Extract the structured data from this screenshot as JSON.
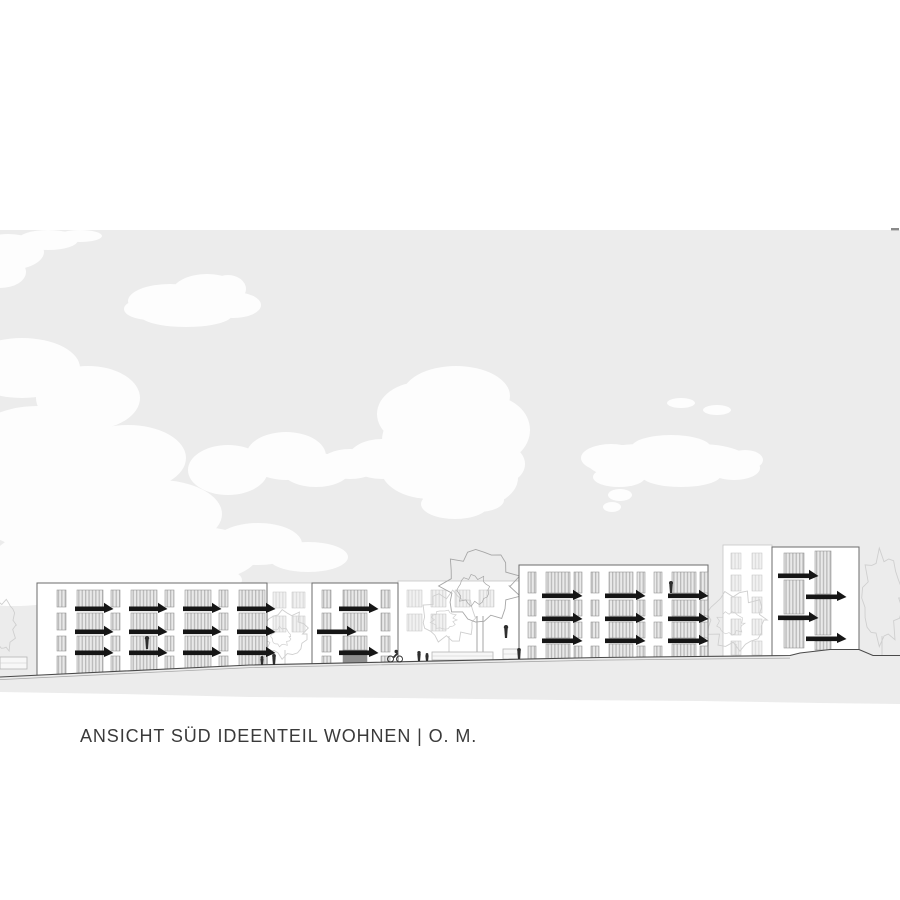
{
  "title": {
    "text": "ANSICHT SÜD IDEENTEIL WOHNEN | O. M."
  },
  "colors": {
    "page_bg": "#ffffff",
    "sky": "#ececec",
    "cloud": "#fdfdfd",
    "line_dark": "#4a4a4a",
    "line_light": "#a8a8a8",
    "building_fill": "#ffffff",
    "building_stroke": "#6b6b6b",
    "window_base": "#e9e9e9",
    "window_stripe": "#b9b9b9",
    "window_frame": "#8f8f8f",
    "balcony": "#161616",
    "door_dark": "#8e8e8e",
    "faint_stroke": "#c6c6c6",
    "faint_window_base": "#f1f1f1",
    "faint_window_stripe": "#dddddd",
    "tree_dark": "#a6a6a6",
    "tree_light": "#cfcfcf",
    "person": "#2e2e2e",
    "title_color": "#3a3a3a",
    "edge_mark": "#8a8a8a"
  },
  "scene": {
    "canvas": {
      "w": 900,
      "h": 900
    },
    "sky": {
      "top": 230,
      "edge_mark": {
        "x": 891,
        "y": 228,
        "w": 8,
        "h": 2.4
      }
    },
    "ground": {
      "line": [
        [
          0,
          677
        ],
        [
          250,
          665
        ],
        [
          600,
          657.5
        ],
        [
          790,
          655.5
        ],
        [
          800,
          653
        ],
        [
          830,
          649.5
        ],
        [
          859,
          649.5
        ],
        [
          873,
          655.5
        ],
        [
          900,
          655.5
        ]
      ],
      "bottom": [
        [
          900,
          704
        ],
        [
          820,
          703
        ],
        [
          700,
          701
        ],
        [
          560,
          700
        ],
        [
          400,
          698
        ],
        [
          250,
          697
        ],
        [
          120,
          694
        ],
        [
          0,
          692
        ]
      ],
      "light_line_max_x": 790
    },
    "clouds": [
      {
        "name": "cloud-top-left-corner",
        "ellipses": [
          [
            8,
            252,
            36,
            18
          ],
          [
            48,
            240,
            30,
            10
          ],
          [
            0,
            272,
            26,
            16
          ],
          [
            80,
            236,
            22,
            6
          ]
        ]
      },
      {
        "name": "cloud-small-upper-left",
        "ellipses": [
          [
            170,
            301,
            42,
            17
          ],
          [
            207,
            294,
            36,
            20
          ],
          [
            233,
            305,
            28,
            13
          ],
          [
            186,
            315,
            46,
            12
          ],
          [
            150,
            309,
            26,
            11
          ],
          [
            228,
            289,
            18,
            14
          ]
        ]
      },
      {
        "name": "cloud-left-edge",
        "ellipses": [
          [
            22,
            368,
            58,
            30
          ],
          [
            88,
            398,
            52,
            32
          ],
          [
            38,
            448,
            72,
            42
          ],
          [
            128,
            458,
            58,
            33
          ]
        ]
      },
      {
        "name": "cloud-lower-left-mass",
        "ellipses": [
          [
            58,
            508,
            84,
            44
          ],
          [
            158,
            514,
            64,
            34
          ],
          [
            88,
            558,
            94,
            34
          ],
          [
            198,
            554,
            60,
            27
          ],
          [
            258,
            544,
            44,
            21
          ],
          [
            308,
            557,
            40,
            15
          ],
          [
            14,
            584,
            70,
            22
          ],
          [
            228,
            470,
            40,
            25
          ],
          [
            162,
            580,
            80,
            20
          ]
        ]
      },
      {
        "name": "cloud-mid-small",
        "ellipses": [
          [
            286,
            456,
            40,
            24
          ],
          [
            316,
            470,
            34,
            17
          ]
        ]
      },
      {
        "name": "cloud-central-large",
        "ellipses": [
          [
            456,
            396,
            54,
            30
          ],
          [
            446,
            440,
            64,
            42
          ],
          [
            490,
            430,
            40,
            34
          ],
          [
            421,
            414,
            44,
            32
          ],
          [
            464,
            478,
            54,
            32
          ],
          [
            431,
            469,
            50,
            30
          ],
          [
            500,
            464,
            25,
            20
          ],
          [
            382,
            459,
            34,
            20
          ],
          [
            350,
            464,
            30,
            15
          ],
          [
            455,
            504,
            34,
            15
          ],
          [
            478,
            500,
            26,
            12
          ]
        ]
      },
      {
        "name": "cloud-right",
        "ellipses": [
          [
            641,
            462,
            54,
            18
          ],
          [
            699,
            461,
            50,
            17
          ],
          [
            611,
            458,
            30,
            14
          ],
          [
            734,
            468,
            26,
            12
          ],
          [
            671,
            448,
            40,
            13
          ],
          [
            619,
            477,
            26,
            10
          ],
          [
            681,
            475,
            40,
            12
          ],
          [
            745,
            460,
            18,
            10
          ]
        ]
      },
      {
        "name": "cloud-right-wisps",
        "ellipses": [
          [
            681,
            403,
            14,
            5
          ],
          [
            717,
            410,
            14,
            5
          ],
          [
            620,
            495,
            12,
            6
          ],
          [
            612,
            507,
            9,
            5
          ]
        ]
      }
    ],
    "background_strips": [
      {
        "name": "bg-strip-1",
        "x": 267,
        "w": 45,
        "top": 583,
        "bottom": 676,
        "windows": [
          [
            273,
            592,
            13,
            16
          ],
          [
            292,
            592,
            13,
            16
          ],
          [
            273,
            616,
            13,
            16
          ],
          [
            292,
            616,
            13,
            16
          ]
        ]
      },
      {
        "name": "bg-strip-2",
        "x": 398,
        "w": 121,
        "top": 581,
        "bottom": 672,
        "windows": [
          [
            407,
            590,
            15,
            17
          ],
          [
            431,
            590,
            15,
            17
          ],
          [
            455,
            590,
            15,
            17
          ],
          [
            479,
            590,
            15,
            17
          ],
          [
            407,
            614,
            15,
            17
          ],
          [
            431,
            614,
            15,
            17
          ]
        ]
      }
    ],
    "buildings": [
      {
        "name": "building-4-background",
        "x": 723,
        "w": 49,
        "top": 545,
        "bottom": 670,
        "kind": "faint",
        "windows": [
          [
            731,
            553,
            10,
            16
          ],
          [
            752,
            553,
            10,
            16
          ],
          [
            731,
            575,
            10,
            16
          ],
          [
            752,
            575,
            10,
            16
          ],
          [
            731,
            597,
            10,
            16
          ],
          [
            752,
            597,
            10,
            16
          ],
          [
            731,
            619,
            10,
            16
          ],
          [
            752,
            619,
            10,
            16
          ],
          [
            731,
            641,
            10,
            14
          ],
          [
            752,
            641,
            10,
            14
          ]
        ]
      },
      {
        "name": "building-1",
        "x": 37,
        "w": 230,
        "top": 583,
        "bottom": 684,
        "kind": "main",
        "narrow": {
          "xs": [
            57,
            111,
            165,
            219
          ],
          "w": 9
        },
        "wide": {
          "xs": [
            77,
            131,
            185,
            239
          ],
          "w": 26
        },
        "rows": [
          {
            "y": 590,
            "h": 17
          },
          {
            "y": 613,
            "h": 17
          },
          {
            "y": 636,
            "h": 15
          }
        ],
        "door_row": {
          "wide_y": 654,
          "wide_h": 28,
          "narrow_y": 656,
          "narrow_h": 20
        },
        "slab_rows": [
          607,
          630,
          651
        ],
        "slab_dx": -2,
        "slab_w": 30
      },
      {
        "name": "building-2",
        "x": 312,
        "w": 86,
        "top": 583,
        "bottom": 684,
        "kind": "main",
        "narrow": {
          "xs": [
            322,
            381
          ],
          "w": 9
        },
        "wide": {
          "xs": [
            343
          ],
          "w": 24
        },
        "rows": [
          {
            "y": 590,
            "h": 18
          },
          {
            "y": 613,
            "h": 18
          },
          {
            "y": 636,
            "h": 16
          }
        ],
        "door_row": {
          "wide_y": 650,
          "wide_h": 22,
          "narrow_y": 656,
          "narrow_h": 16,
          "dark": true
        },
        "slabs": [
          {
            "x": 339,
            "y": 607,
            "w": 31
          },
          {
            "x": 317,
            "y": 630,
            "w": 31
          },
          {
            "x": 339,
            "y": 651,
            "w": 31
          }
        ]
      },
      {
        "name": "building-3",
        "x": 519,
        "w": 189,
        "top": 565,
        "bottom": 684,
        "kind": "main",
        "narrow": {
          "xs": [
            528,
            574,
            591,
            637,
            654,
            700
          ],
          "w": 8
        },
        "wide": {
          "xs": [
            546,
            609,
            672
          ],
          "w": 24
        },
        "rows": [
          {
            "y": 572,
            "h": 21
          },
          {
            "y": 600,
            "h": 16
          },
          {
            "y": 622,
            "h": 16
          }
        ],
        "door_row": {
          "wide_y": 644,
          "wide_h": 22,
          "narrow_y": 646,
          "narrow_h": 14
        },
        "slab_rows": [
          594,
          617,
          639
        ],
        "slab_dx": -4,
        "slab_w": 32
      },
      {
        "name": "building-5",
        "x": 772,
        "w": 87,
        "top": 547,
        "bottom": 670,
        "kind": "main",
        "windows": [
          [
            784,
            553,
            20,
            21
          ],
          [
            784,
            580,
            20,
            34
          ],
          [
            784,
            620,
            20,
            28
          ],
          [
            815,
            551,
            16,
            43
          ],
          [
            815,
            599,
            16,
            36
          ],
          [
            815,
            641,
            16,
            9
          ]
        ],
        "slabs": [
          {
            "x": 778,
            "y": 574,
            "w": 32
          },
          {
            "x": 806,
            "y": 595,
            "w": 32
          },
          {
            "x": 778,
            "y": 616,
            "w": 32
          },
          {
            "x": 806,
            "y": 637,
            "w": 32
          }
        ]
      }
    ],
    "trees": [
      {
        "name": "shrub-left-edge",
        "cx": 5,
        "cy": 625,
        "rx": 10,
        "ry": 24,
        "stroke": "tree_light",
        "trunk": []
      },
      {
        "name": "tree-between-b1-b2",
        "cx": 285,
        "cy": 634,
        "rx": 21,
        "ry": 22,
        "stroke": "tree_light",
        "trunk": [
          [
            285,
            650,
            285,
            665
          ]
        ]
      },
      {
        "name": "tree-mid-small",
        "cx": 449,
        "cy": 617,
        "rx": 26,
        "ry": 23,
        "stroke": "tree_light",
        "trunk": [
          [
            449,
            636,
            449,
            661
          ]
        ]
      },
      {
        "name": "tree-large",
        "cx": 480,
        "cy": 586,
        "rx": 34,
        "ry": 35,
        "stroke": "tree_dark",
        "trunk": [
          [
            477,
            616,
            477,
            660
          ],
          [
            483,
            616,
            483,
            660
          ]
        ]
      },
      {
        "name": "tree-front-b4",
        "cx": 736,
        "cy": 620,
        "rx": 28,
        "ry": 27,
        "stroke": "tree_light",
        "trunk": [
          [
            736,
            644,
            736,
            656
          ]
        ]
      },
      {
        "name": "tree-right-edge",
        "cx": 882,
        "cy": 598,
        "rx": 19,
        "ry": 42,
        "stroke": "tree_light",
        "trunk": [
          [
            882,
            636,
            882,
            656
          ]
        ]
      }
    ],
    "props": [
      {
        "name": "planter-wall",
        "x": 432,
        "y": 652,
        "w": 61,
        "h": 8
      },
      {
        "name": "entrance-canopy",
        "x": 503,
        "y": 649,
        "w": 17,
        "h": 10
      },
      {
        "name": "wall-left-edge",
        "x": 0,
        "y": 657,
        "w": 27,
        "h": 12
      }
    ],
    "people": [
      {
        "name": "pedestrian-1",
        "x": 262,
        "foot_y": 665,
        "h": 9,
        "kind": "stand"
      },
      {
        "name": "pedestrian-2",
        "x": 274,
        "foot_y": 665,
        "h": 11,
        "kind": "stand"
      },
      {
        "name": "cyclist",
        "x": 395,
        "foot_y": 662,
        "h": 12,
        "kind": "cyclist"
      },
      {
        "name": "pedestrian-3",
        "x": 419,
        "foot_y": 661,
        "h": 10,
        "kind": "stand"
      },
      {
        "name": "pedestrian-4",
        "x": 427,
        "foot_y": 661,
        "h": 8,
        "kind": "stand"
      },
      {
        "name": "pedestrian-5",
        "x": 519,
        "foot_y": 659,
        "h": 11,
        "kind": "stand"
      },
      {
        "name": "figure-terrace",
        "x": 506,
        "foot_y": 638,
        "h": 13,
        "kind": "stand"
      },
      {
        "name": "figure-balcony-b3",
        "x": 671,
        "foot_y": 593,
        "h": 12,
        "kind": "stand"
      },
      {
        "name": "figure-window-b1",
        "x": 147,
        "foot_y": 649,
        "h": 13,
        "kind": "stand"
      }
    ]
  }
}
